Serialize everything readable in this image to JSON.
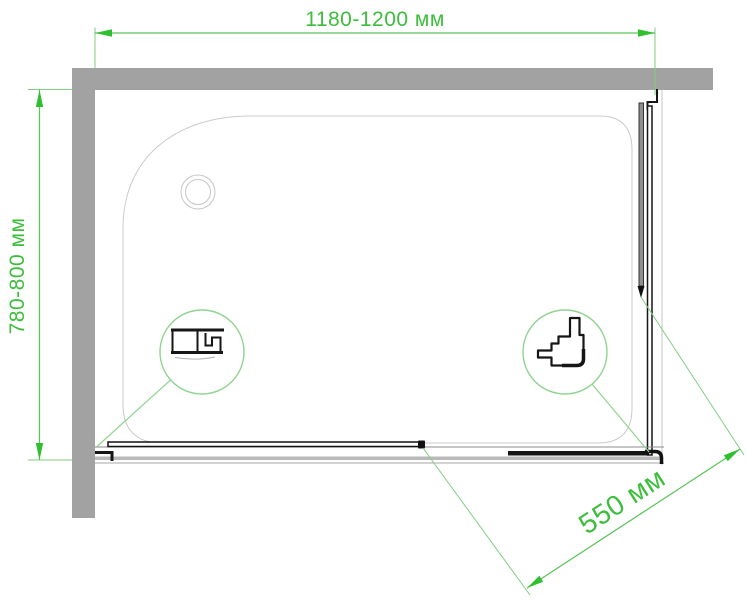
{
  "diagram": {
    "dimensions": {
      "width_label": "1180-1200 мм",
      "depth_label": "780-800 мм",
      "entry_label": "550 мм"
    },
    "colors": {
      "dimension_green": "#3CBE3C",
      "extension_line_green": "#82CE82",
      "detail_circle_green": "#8FD48F",
      "wall_gray": "#A2A2A2",
      "tray_outline_gray": "#CBCBCB",
      "profile_black": "#161616"
    }
  }
}
